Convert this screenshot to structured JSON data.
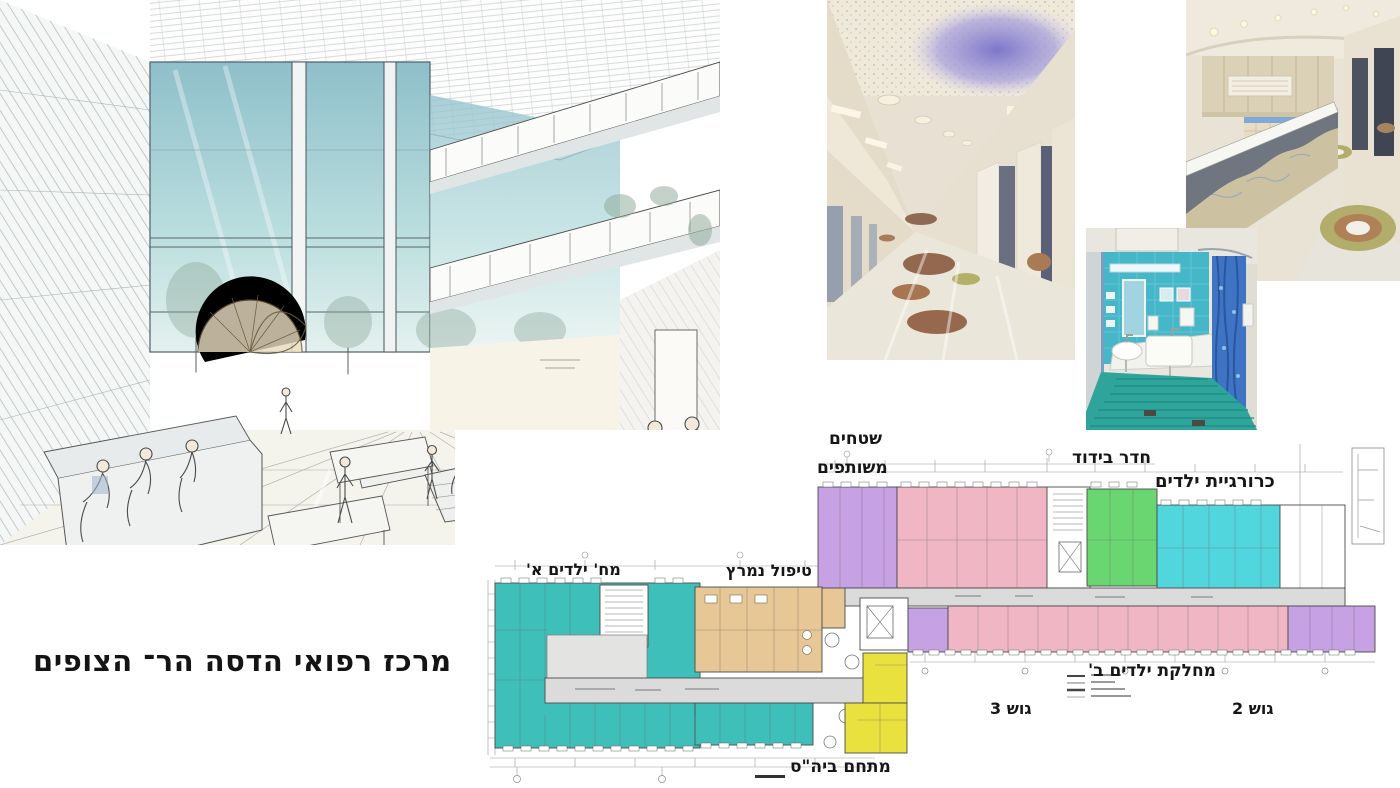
{
  "slide": {
    "title": "מרכז רפואי הדסה הר־ הצופים"
  },
  "plan_labels": {
    "shared_areas_line1": "שטחים",
    "shared_areas_line2": "משותפים",
    "isolation_room": "חדר בידוד",
    "pediatric_surgery": "כרורגיית ילדים",
    "children_ward_a": "מח' ילדים א'",
    "intensive_care": "טיפול נמרץ",
    "children_ward_b": "מחלקת ילדים ב'",
    "block_3": "גוש 3",
    "block_2": "גוש 2",
    "school_compound": "מתחם ביה\"ס"
  },
  "colors": {
    "plan_teal": "#3fbfba",
    "plan_cyan": "#52d6de",
    "plan_pink": "#f1b6c4",
    "plan_purple": "#c6a2e4",
    "plan_green": "#6ad671",
    "plan_yellow": "#e9e23e",
    "plan_tan": "#e7c795",
    "plan_corridor": "#dbdbdb",
    "label_ink": "#161616",
    "title_ink": "#141414"
  }
}
